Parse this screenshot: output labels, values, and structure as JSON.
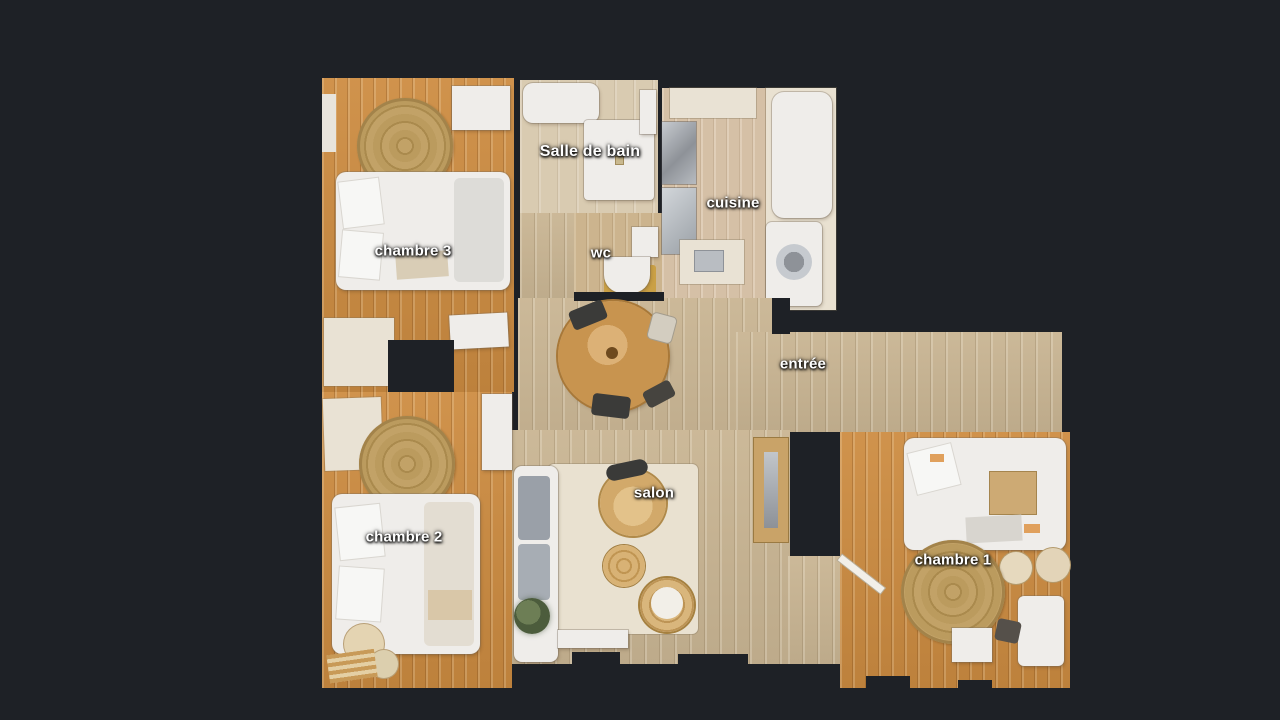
{
  "app": {
    "view_name": "floorplan-top-view",
    "background_color": "#1e2126"
  },
  "floorplan": {
    "rooms": [
      {
        "id": "chambre-3",
        "label": "chambre 3"
      },
      {
        "id": "salle-de-bain",
        "label": "Salle de bain"
      },
      {
        "id": "wc",
        "label": "wc"
      },
      {
        "id": "cuisine",
        "label": "cuisine"
      },
      {
        "id": "entree",
        "label": "entrée"
      },
      {
        "id": "salon",
        "label": "salon"
      },
      {
        "id": "chambre-2",
        "label": "chambre 2"
      },
      {
        "id": "chambre-1",
        "label": "chambre 1"
      }
    ],
    "colors": {
      "bg": "#1e2126",
      "wood_orange": "#cd8c41",
      "wood_orange_dark": "#c07a31",
      "wood_pale": "#c9b593",
      "wood_kitchen": "#d5c0a6",
      "tile": "#d9cbb1",
      "furniture_white": "#efedea",
      "rug_cream": "#e9e1d0",
      "rug_jute": "#bd9d61",
      "sofa_gray": "#9aa0a8",
      "steel": "#aeb2b8",
      "table_wood": "#c8944f",
      "label_text": "#ffffff"
    }
  }
}
